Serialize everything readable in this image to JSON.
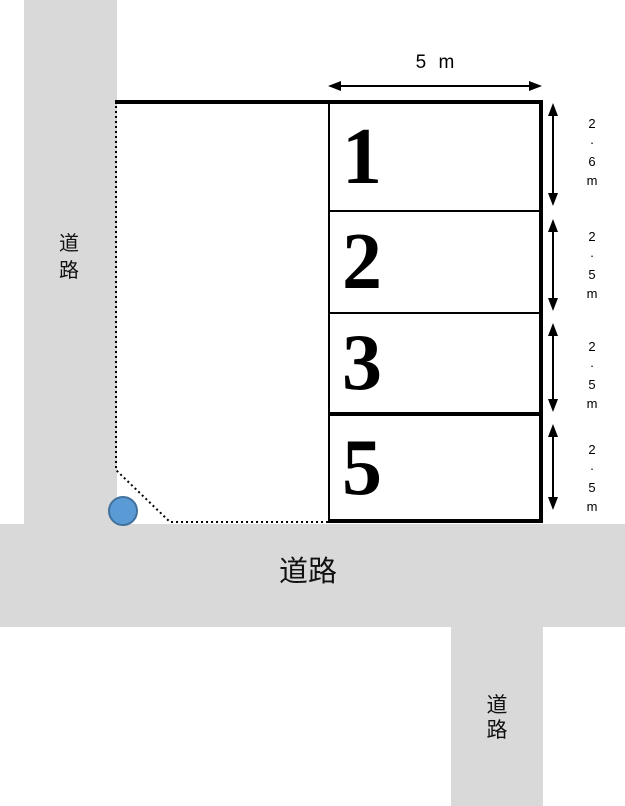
{
  "labels": {
    "road_left": "道\n路",
    "road_bottom": "道路",
    "road_bottom_right": "道\n路",
    "width_dimension": "5 m"
  },
  "spaces": [
    {
      "number": "1",
      "height_label": "2\n·\n6\nm",
      "height_m": 2.6,
      "width_m": 5
    },
    {
      "number": "2",
      "height_label": "2\n·\n5\nm",
      "height_m": 2.5,
      "width_m": 5
    },
    {
      "number": "3",
      "height_label": "2\n·\n5\nm",
      "height_m": 2.5,
      "width_m": 5
    },
    {
      "number": "5",
      "height_label": "2\n·\n5\nm",
      "height_m": 2.5,
      "width_m": 5
    }
  ],
  "colors": {
    "road_gray": "#d9d9d9",
    "line_black": "#000000",
    "marker_fill": "#5b9bd5",
    "marker_stroke": "#41719c"
  }
}
